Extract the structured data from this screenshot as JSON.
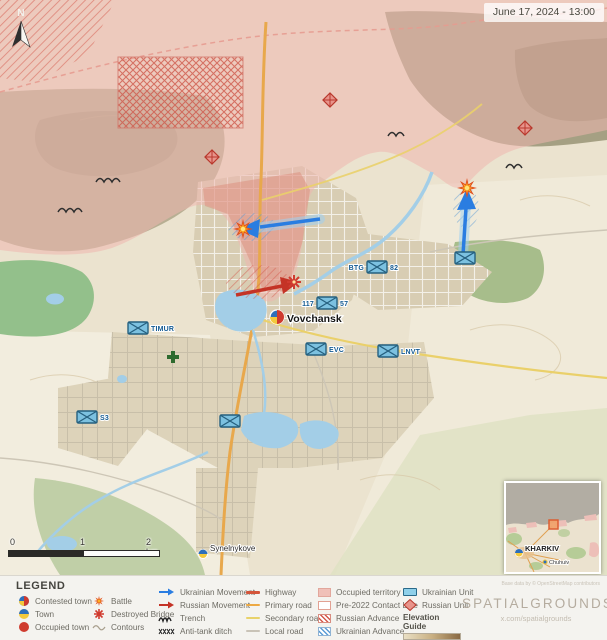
{
  "title_bar": {
    "date": "June 17, 2024 - 13:00"
  },
  "compass": {
    "label": "N"
  },
  "map": {
    "labels": {
      "vovchansk": "Vovchansk",
      "synelnykove": "Synelnykove"
    },
    "units": {
      "btg": "BTG",
      "n82": "82",
      "n117": "117",
      "n57": "57",
      "evc": "EVC",
      "lnvt": "LNVT",
      "timur": "TIMUR",
      "s3": "S3"
    }
  },
  "scale_bar": {
    "zero": "0",
    "one": "1",
    "two": "2 km"
  },
  "inset": {
    "city": "KHARKIV",
    "town": "Chuhuiv"
  },
  "legend": {
    "title": "LEGEND",
    "col1": [
      "Contested town",
      "Town",
      "Occupied town"
    ],
    "col2": [
      "Battle",
      "Destroyed Bridge",
      "Contours"
    ],
    "col3": [
      "Ukrainian Movement",
      "Russian Movement",
      "Trench",
      "Anti-tank ditch"
    ],
    "col4": [
      "Highway",
      "Primary road",
      "Secondary road",
      "Local road"
    ],
    "col5": [
      "Occupied territory",
      "Pre-2022 Contact Line",
      "Russian Advance",
      "Ukrainian Advance"
    ],
    "col6": [
      "Ukrainian Unit",
      "Russian Unit"
    ],
    "elevation": {
      "title": "Elevation Guide",
      "low": "Lowlands",
      "high": "Mountains"
    }
  },
  "footer": {
    "brand": "SPATIALGROUNDS",
    "handle": "x.com/spatialgrounds",
    "attribution": "Base data by © OpenStreetMap contributors"
  },
  "colors": {
    "occupied_territory": "#eeb6ae",
    "ukrainian_blue": "#2a7de1",
    "russian_red": "#c43326",
    "ukrainian_unit_fill": "#7cc1e0",
    "water": "#a3cee7",
    "road_highway": "#d4553a",
    "road_primary": "#e8a84c",
    "road_secondary": "#ead06a",
    "terrain": "#ebe3cf",
    "legend_bg": "#f4f3ef",
    "brand_gray": "#b5ac9f"
  }
}
